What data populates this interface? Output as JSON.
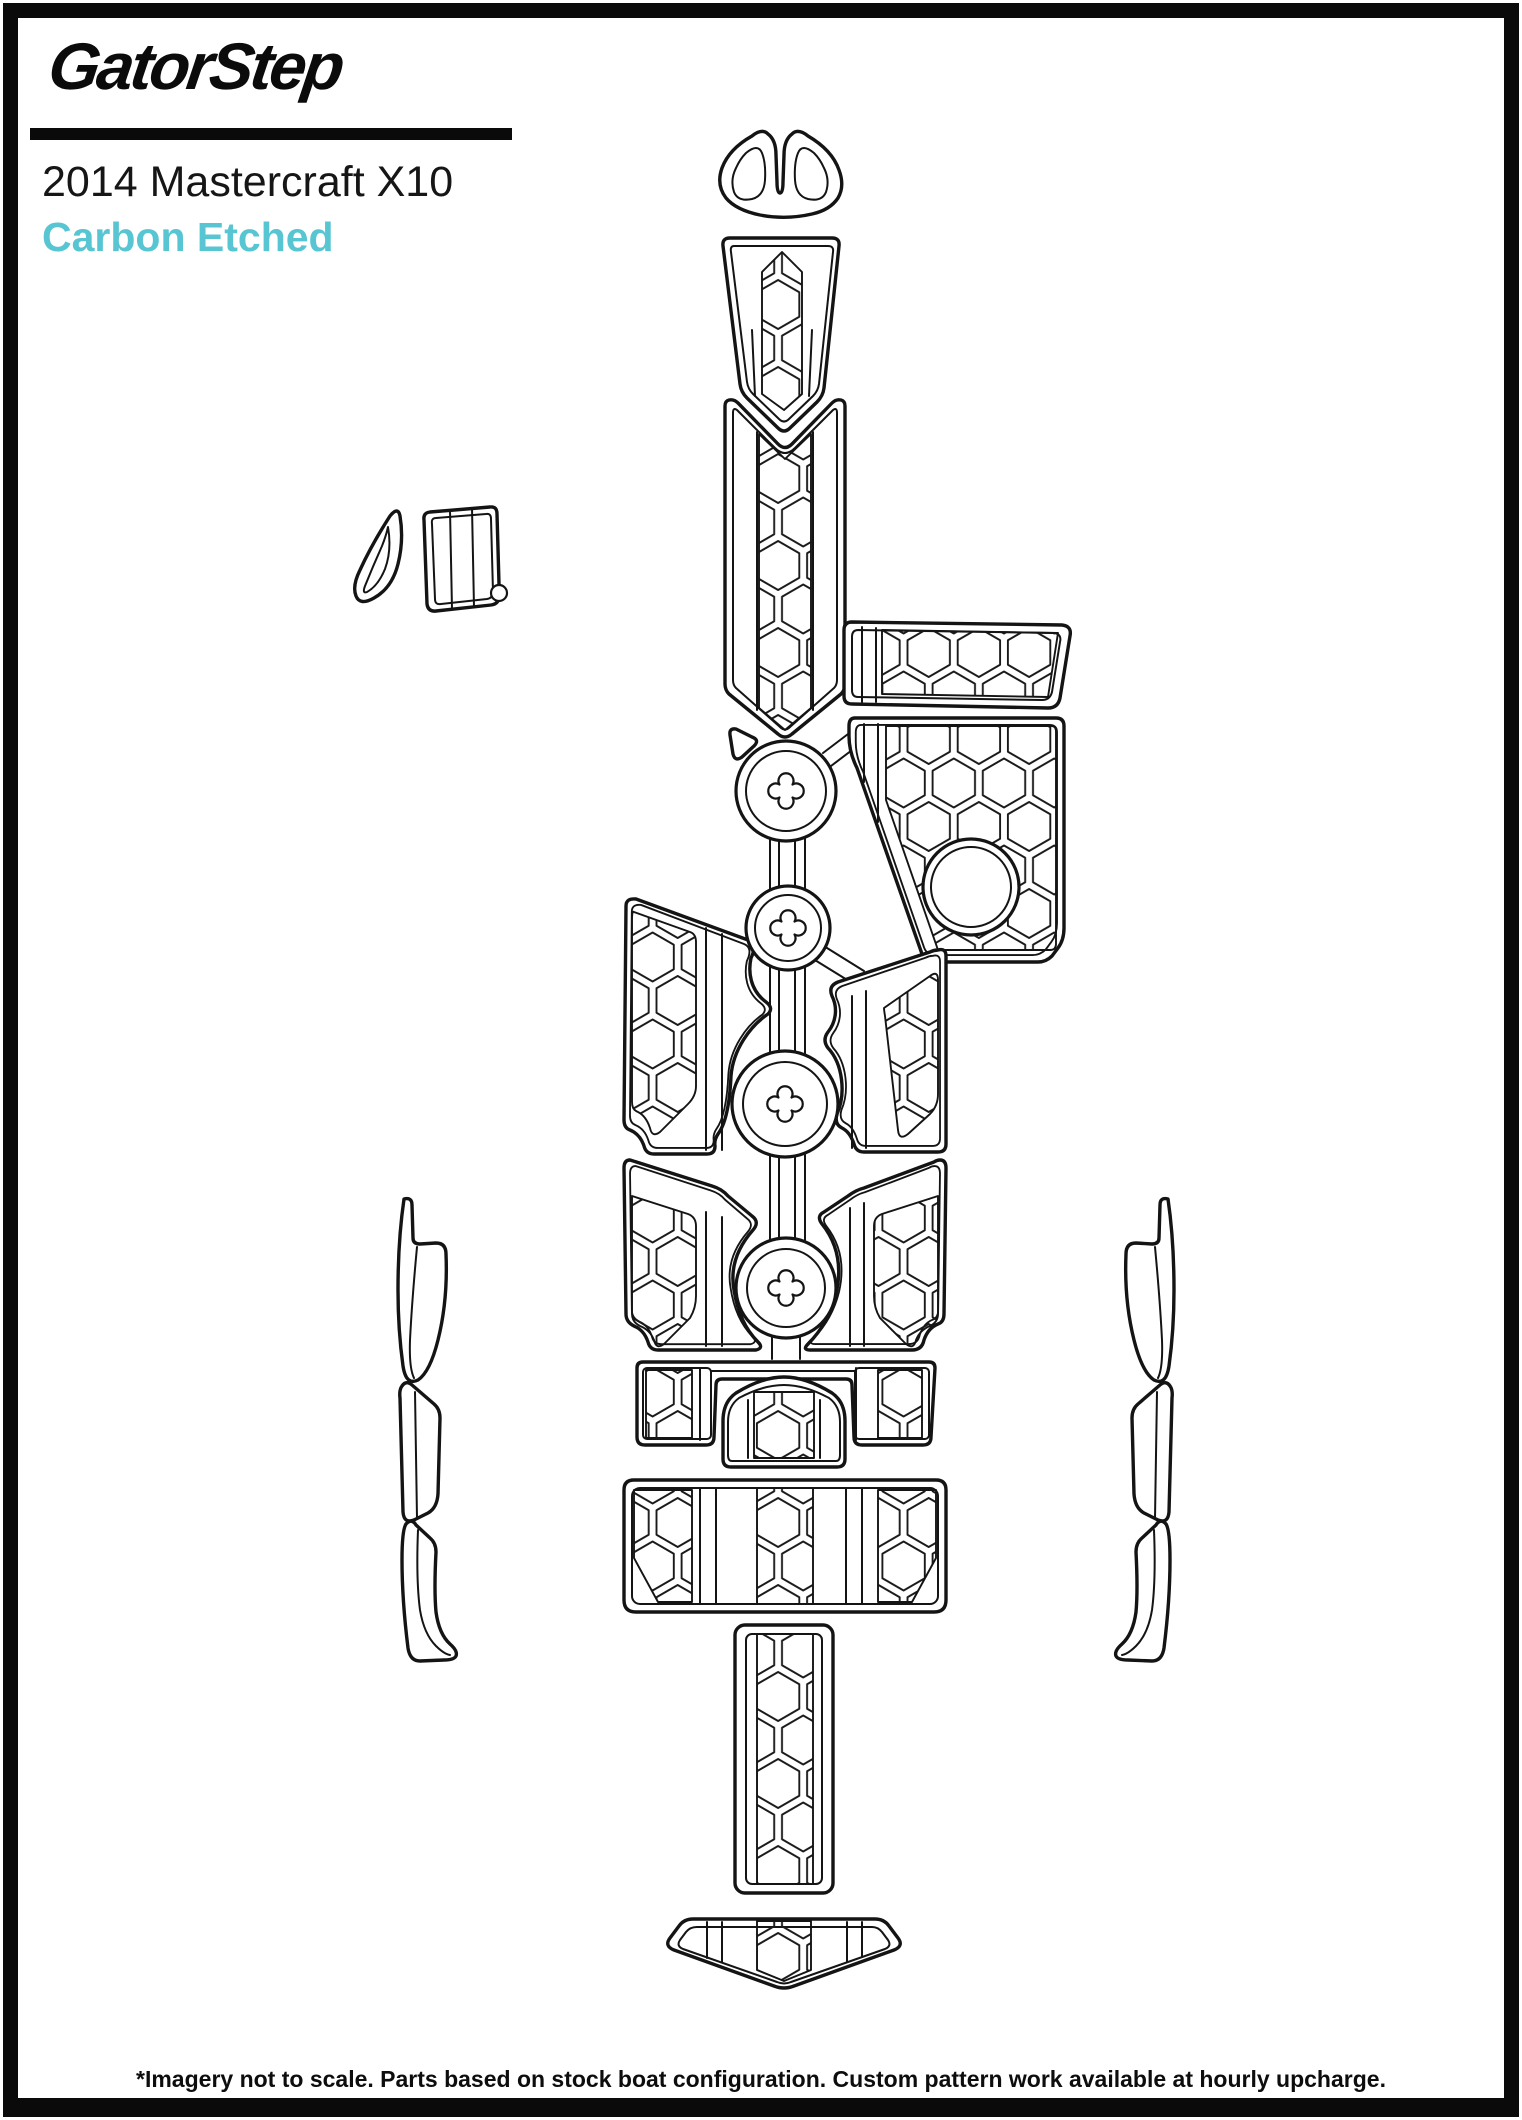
{
  "header": {
    "logo_text": "GatorStep",
    "title": "2014 Mastercraft X10",
    "subtitle": "Carbon Etched"
  },
  "footer": {
    "disclaimer": "*Imagery not to scale. Parts based on stock boat configuration. Custom pattern work available at hourly upcharge."
  },
  "colors": {
    "accent": "#58c5d2",
    "ink": "#141414",
    "background": "#ffffff",
    "border": "#0a0a0a"
  }
}
